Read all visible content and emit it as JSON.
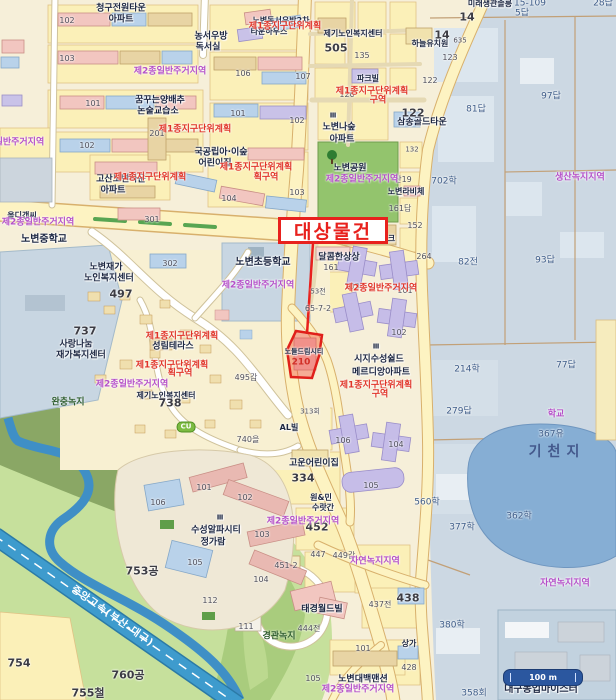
{
  "annotation": {
    "target_label": "대상물건"
  },
  "scale_bar": {
    "label": "100 m"
  },
  "colors": {
    "annotation_red": "#e8211d",
    "zoning_red": "#e03428",
    "zoning_purple": "#b44fc8",
    "field_blue": "#ccd8e3",
    "pond_blue": "#86aed4",
    "park_green": "#93c46d",
    "expressway_blue": "#3e9bcd",
    "road_yellow": "#fdf3c2",
    "scale_navy": "#2b579f"
  },
  "labels": [
    {
      "t": "청구전원타운",
      "x": 121,
      "y": 9,
      "c": "poi"
    },
    {
      "t": "아파트",
      "x": 121,
      "y": 20,
      "c": "poi"
    },
    {
      "t": "농서우방",
      "x": 211,
      "y": 37,
      "c": "poi"
    },
    {
      "t": "독서실",
      "x": 208,
      "y": 48,
      "c": "poi"
    },
    {
      "t": "노변동서우방2차",
      "x": 281,
      "y": 21,
      "c": "poi",
      "s": 8
    },
    {
      "t": "타운하우스",
      "x": 269,
      "y": 32,
      "c": "poi",
      "s": 8
    },
    {
      "t": "제기노인복지센터",
      "x": 353,
      "y": 34,
      "c": "poi",
      "s": 8
    },
    {
      "t": "하늘유치원",
      "x": 430,
      "y": 44,
      "c": "poi",
      "s": 8
    },
    {
      "t": "파크빌",
      "x": 368,
      "y": 79,
      "c": "poi",
      "s": 8
    },
    {
      "t": "삼송골드타운",
      "x": 422,
      "y": 123,
      "c": "poi"
    },
    {
      "t": "꿈꾸는양배추",
      "x": 160,
      "y": 101,
      "c": "poi"
    },
    {
      "t": "논술교습소",
      "x": 158,
      "y": 112,
      "c": "poi"
    },
    {
      "t": "국공립아·이숲",
      "x": 221,
      "y": 153,
      "c": "poi"
    },
    {
      "t": "어린이집",
      "x": 215,
      "y": 164,
      "c": "poi"
    },
    {
      "t": "Ⅲ",
      "x": 333,
      "y": 116,
      "c": "poi",
      "s": 7
    },
    {
      "t": "노변나숲",
      "x": 339,
      "y": 128,
      "c": "poi"
    },
    {
      "t": "아파트",
      "x": 342,
      "y": 140,
      "c": "poi"
    },
    {
      "t": "고산노변타운",
      "x": 121,
      "y": 180,
      "c": "poi"
    },
    {
      "t": "아파트",
      "x": 113,
      "y": 191,
      "c": "poi"
    },
    {
      "t": "노변중학교",
      "x": 44,
      "y": 240,
      "c": "poi",
      "s": 10
    },
    {
      "t": "노변초등학교",
      "x": 263,
      "y": 263,
      "c": "poi",
      "s": 10
    },
    {
      "t": "노변재가",
      "x": 106,
      "y": 268,
      "c": "poi"
    },
    {
      "t": "노인복지센터",
      "x": 109,
      "y": 279,
      "c": "poi"
    },
    {
      "t": "올디갠씨",
      "x": 22,
      "y": 216,
      "c": "poi",
      "s": 8
    },
    {
      "t": "사랑나눔",
      "x": 76,
      "y": 345,
      "c": "poi"
    },
    {
      "t": "재가복지센터",
      "x": 81,
      "y": 356,
      "c": "poi"
    },
    {
      "t": "성림테라스",
      "x": 173,
      "y": 347,
      "c": "poi"
    },
    {
      "t": "제기노인복지센터",
      "x": 166,
      "y": 396,
      "c": "poi",
      "s": 8
    },
    {
      "t": "노변라비체",
      "x": 406,
      "y": 192,
      "c": "poi",
      "s": 8
    },
    {
      "t": "달콤한상상",
      "x": 339,
      "y": 258,
      "c": "poi"
    },
    {
      "t": "노변엔씨테크",
      "x": 373,
      "y": 239,
      "c": "poi",
      "s": 8
    },
    {
      "t": "노변공원",
      "x": 350,
      "y": 169,
      "c": "poi"
    },
    {
      "t": "Ⅲ",
      "x": 376,
      "y": 347,
      "c": "poi",
      "s": 7
    },
    {
      "t": "시지수성쉴드",
      "x": 379,
      "y": 360,
      "c": "poi"
    },
    {
      "t": "메르디앙아파트",
      "x": 381,
      "y": 373,
      "c": "poi"
    },
    {
      "t": "고운어린이집",
      "x": 314,
      "y": 464,
      "c": "poi"
    },
    {
      "t": "AL빌",
      "x": 289,
      "y": 428,
      "c": "poi",
      "s": 8
    },
    {
      "t": "태경월드빌",
      "x": 322,
      "y": 610,
      "c": "poi"
    },
    {
      "t": "원&민",
      "x": 321,
      "y": 498,
      "c": "poi",
      "s": 8
    },
    {
      "t": "수랏간",
      "x": 323,
      "y": 508,
      "c": "poi",
      "s": 8
    },
    {
      "t": "노변대백맨션",
      "x": 363,
      "y": 680,
      "c": "poi"
    },
    {
      "t": "Ⅲ",
      "x": 220,
      "y": 518,
      "c": "poi",
      "s": 7
    },
    {
      "t": "수성알파시티",
      "x": 216,
      "y": 531,
      "c": "poi"
    },
    {
      "t": "정가람",
      "x": 213,
      "y": 543,
      "c": "poi"
    },
    {
      "t": "상가",
      "x": 409,
      "y": 644,
      "c": "poi",
      "s": 8
    },
    {
      "t": "대구농업마이스터",
      "x": 541,
      "y": 690,
      "c": "poi",
      "s": 10
    },
    {
      "t": "노들드림시티",
      "x": 304,
      "y": 352,
      "c": "poi",
      "s": 7
    },
    {
      "t": "미래생관솔릉",
      "x": 490,
      "y": 4,
      "c": "poi",
      "s": 8
    },
    {
      "t": "경관녹지",
      "x": 279,
      "y": 637,
      "c": "grn"
    },
    {
      "t": "완충녹지",
      "x": 68,
      "y": 403,
      "c": "grn"
    },
    {
      "t": "기천지",
      "x": 557,
      "y": 452,
      "c": "water-big"
    },
    {
      "t": "중앙고속(부산-대구)",
      "x": 112,
      "y": 617,
      "c": "hwy",
      "r": 35
    },
    {
      "t": "102",
      "x": 67,
      "y": 21,
      "c": "num"
    },
    {
      "t": "103",
      "x": 67,
      "y": 59,
      "c": "num"
    },
    {
      "t": "101",
      "x": 93,
      "y": 104,
      "c": "num"
    },
    {
      "t": "102",
      "x": 87,
      "y": 146,
      "c": "num"
    },
    {
      "t": "201",
      "x": 157,
      "y": 134,
      "c": "num"
    },
    {
      "t": "301",
      "x": 152,
      "y": 220,
      "c": "num"
    },
    {
      "t": "302",
      "x": 170,
      "y": 264,
      "c": "num"
    },
    {
      "t": "106",
      "x": 243,
      "y": 74,
      "c": "num"
    },
    {
      "t": "107",
      "x": 303,
      "y": 77,
      "c": "num"
    },
    {
      "t": "101",
      "x": 238,
      "y": 114,
      "c": "num"
    },
    {
      "t": "102",
      "x": 297,
      "y": 121,
      "c": "num"
    },
    {
      "t": "103",
      "x": 297,
      "y": 193,
      "c": "num"
    },
    {
      "t": "104",
      "x": 229,
      "y": 199,
      "c": "num"
    },
    {
      "t": "126",
      "x": 347,
      "y": 95,
      "c": "num"
    },
    {
      "t": "135",
      "x": 362,
      "y": 56,
      "c": "num"
    },
    {
      "t": "123",
      "x": 450,
      "y": 58,
      "c": "num"
    },
    {
      "t": "122",
      "x": 430,
      "y": 81,
      "c": "num"
    },
    {
      "t": "635",
      "x": 460,
      "y": 41,
      "c": "num",
      "s": 7
    },
    {
      "t": "161",
      "x": 331,
      "y": 268,
      "c": "num"
    },
    {
      "t": "65-7-2",
      "x": 318,
      "y": 309,
      "c": "num"
    },
    {
      "t": "53전",
      "x": 318,
      "y": 292,
      "c": "num",
      "s": 7
    },
    {
      "t": "산19",
      "x": 403,
      "y": 180,
      "c": "num"
    },
    {
      "t": "132",
      "x": 412,
      "y": 150,
      "c": "num",
      "s": 7
    },
    {
      "t": "161답",
      "x": 400,
      "y": 209,
      "c": "num"
    },
    {
      "t": "152",
      "x": 415,
      "y": 226,
      "c": "num"
    },
    {
      "t": "264",
      "x": 424,
      "y": 257,
      "c": "num"
    },
    {
      "t": "495갑",
      "x": 246,
      "y": 378,
      "c": "num"
    },
    {
      "t": "740을",
      "x": 248,
      "y": 440,
      "c": "num"
    },
    {
      "t": "313회",
      "x": 310,
      "y": 412,
      "c": "num",
      "s": 7
    },
    {
      "t": "451-2",
      "x": 286,
      "y": 566,
      "c": "num"
    },
    {
      "t": "447",
      "x": 318,
      "y": 555,
      "c": "num"
    },
    {
      "t": "449갑",
      "x": 344,
      "y": 556,
      "c": "num"
    },
    {
      "t": "444전",
      "x": 309,
      "y": 629,
      "c": "num"
    },
    {
      "t": "437전",
      "x": 380,
      "y": 605,
      "c": "num"
    },
    {
      "t": "428",
      "x": 409,
      "y": 668,
      "c": "num"
    },
    {
      "t": "101",
      "x": 363,
      "y": 649,
      "c": "num"
    },
    {
      "t": "105",
      "x": 313,
      "y": 679,
      "c": "num"
    },
    {
      "t": "104",
      "x": 261,
      "y": 580,
      "c": "num"
    },
    {
      "t": "111",
      "x": 246,
      "y": 627,
      "c": "num"
    },
    {
      "t": "101",
      "x": 204,
      "y": 488,
      "c": "num"
    },
    {
      "t": "102",
      "x": 245,
      "y": 498,
      "c": "num"
    },
    {
      "t": "103",
      "x": 262,
      "y": 535,
      "c": "num"
    },
    {
      "t": "105",
      "x": 195,
      "y": 563,
      "c": "num"
    },
    {
      "t": "106",
      "x": 158,
      "y": 503,
      "c": "num"
    },
    {
      "t": "112",
      "x": 210,
      "y": 601,
      "c": "num"
    },
    {
      "t": "101",
      "x": 405,
      "y": 291,
      "c": "num"
    },
    {
      "t": "102",
      "x": 399,
      "y": 333,
      "c": "num"
    },
    {
      "t": "103",
      "x": 352,
      "y": 287,
      "c": "num"
    },
    {
      "t": "106",
      "x": 343,
      "y": 441,
      "c": "num"
    },
    {
      "t": "104",
      "x": 396,
      "y": 445,
      "c": "num"
    },
    {
      "t": "105",
      "x": 371,
      "y": 486,
      "c": "num"
    },
    {
      "t": "497",
      "x": 121,
      "y": 294,
      "c": "numbold"
    },
    {
      "t": "737",
      "x": 85,
      "y": 331,
      "c": "numbold"
    },
    {
      "t": "738",
      "x": 170,
      "y": 403,
      "c": "numbold"
    },
    {
      "t": "505",
      "x": 336,
      "y": 48,
      "c": "numbold"
    },
    {
      "t": "122",
      "x": 413,
      "y": 113,
      "c": "numbold"
    },
    {
      "t": "14",
      "x": 467,
      "y": 17,
      "c": "numbold"
    },
    {
      "t": "14",
      "x": 442,
      "y": 35,
      "c": "numbold"
    },
    {
      "t": "334",
      "x": 303,
      "y": 478,
      "c": "numbold"
    },
    {
      "t": "452",
      "x": 317,
      "y": 527,
      "c": "numbold"
    },
    {
      "t": "438",
      "x": 408,
      "y": 598,
      "c": "numbold"
    },
    {
      "t": "753공",
      "x": 142,
      "y": 571,
      "c": "numbold"
    },
    {
      "t": "760공",
      "x": 128,
      "y": 675,
      "c": "numbold"
    },
    {
      "t": "755철",
      "x": 88,
      "y": 693,
      "c": "numbold"
    },
    {
      "t": "754",
      "x": 19,
      "y": 663,
      "c": "numbold"
    },
    {
      "t": "97답",
      "x": 551,
      "y": 97,
      "c": "pblue"
    },
    {
      "t": "81답",
      "x": 476,
      "y": 110,
      "c": "pblue"
    },
    {
      "t": "5답",
      "x": 522,
      "y": 14,
      "c": "pblue"
    },
    {
      "t": "28답",
      "x": 603,
      "y": 4,
      "c": "pblue"
    },
    {
      "t": "82전",
      "x": 468,
      "y": 263,
      "c": "pblue"
    },
    {
      "t": "93답",
      "x": 545,
      "y": 261,
      "c": "pblue"
    },
    {
      "t": "214학",
      "x": 467,
      "y": 370,
      "c": "pblue"
    },
    {
      "t": "77답",
      "x": 566,
      "y": 366,
      "c": "pblue"
    },
    {
      "t": "279답",
      "x": 459,
      "y": 412,
      "c": "pblue"
    },
    {
      "t": "367유",
      "x": 551,
      "y": 435,
      "c": "pblue"
    },
    {
      "t": "358회",
      "x": 474,
      "y": 694,
      "c": "pblue"
    },
    {
      "t": "362학",
      "x": 519,
      "y": 517,
      "c": "pblue"
    },
    {
      "t": "377학",
      "x": 462,
      "y": 528,
      "c": "pblue"
    },
    {
      "t": "380학",
      "x": 452,
      "y": 626,
      "c": "pblue"
    },
    {
      "t": "560학",
      "x": 427,
      "y": 503,
      "c": "pblue"
    },
    {
      "t": "702학",
      "x": 444,
      "y": 182,
      "c": "pblue"
    },
    {
      "t": "15-109",
      "x": 530,
      "y": 4,
      "c": "pblue"
    },
    {
      "t": "제1종지구단위계획",
      "x": 285,
      "y": 27,
      "c": "zr"
    },
    {
      "t": "제1종지구단위계획",
      "x": 195,
      "y": 130,
      "c": "zr"
    },
    {
      "t": "제1종지구단위계획",
      "x": 150,
      "y": 178,
      "c": "zr"
    },
    {
      "t": "제1종지구단위계획",
      "x": 256,
      "y": 168,
      "c": "zr"
    },
    {
      "t": "획구역",
      "x": 266,
      "y": 178,
      "c": "zr"
    },
    {
      "t": "제1종지구단위계획",
      "x": 372,
      "y": 92,
      "c": "zr"
    },
    {
      "t": "구역",
      "x": 378,
      "y": 101,
      "c": "zr"
    },
    {
      "t": "제2종일반주거지역",
      "x": 381,
      "y": 289,
      "c": "zr"
    },
    {
      "t": "제1종지구단위계획",
      "x": 376,
      "y": 386,
      "c": "zr"
    },
    {
      "t": "구역",
      "x": 380,
      "y": 395,
      "c": "zr"
    },
    {
      "t": "제1종지구단위계획",
      "x": 182,
      "y": 337,
      "c": "zr"
    },
    {
      "t": "제1종지구단위계획",
      "x": 172,
      "y": 366,
      "c": "zr"
    },
    {
      "t": "획구역",
      "x": 180,
      "y": 374,
      "c": "zr"
    },
    {
      "t": "제2종일반주거지역",
      "x": 170,
      "y": 72,
      "c": "zp"
    },
    {
      "t": "제2종일반주거지역",
      "x": 8,
      "y": 143,
      "c": "zp"
    },
    {
      "t": "제2종일반주거지역",
      "x": 38,
      "y": 223,
      "c": "zp"
    },
    {
      "t": "제2종일반주거지역",
      "x": 258,
      "y": 286,
      "c": "zp"
    },
    {
      "t": "제2종일반주거지역",
      "x": 132,
      "y": 385,
      "c": "zp"
    },
    {
      "t": "제2종일반주거지역",
      "x": 303,
      "y": 522,
      "c": "zp"
    },
    {
      "t": "제2종일반주거지역",
      "x": 358,
      "y": 690,
      "c": "zp"
    },
    {
      "t": "제2종일반주거지역",
      "x": 362,
      "y": 180,
      "c": "zp"
    },
    {
      "t": "생산녹지지역",
      "x": 580,
      "y": 178,
      "c": "zp"
    },
    {
      "t": "자연녹지지역",
      "x": 565,
      "y": 584,
      "c": "zp"
    },
    {
      "t": "자연녹지지역",
      "x": 375,
      "y": 562,
      "c": "zp"
    },
    {
      "t": "학교",
      "x": 556,
      "y": 415,
      "c": "zp"
    },
    {
      "t": "210",
      "x": 301,
      "y": 363,
      "c": "num-red"
    },
    {
      "t": "CU",
      "x": 186,
      "y": 427,
      "c": "cu"
    }
  ]
}
